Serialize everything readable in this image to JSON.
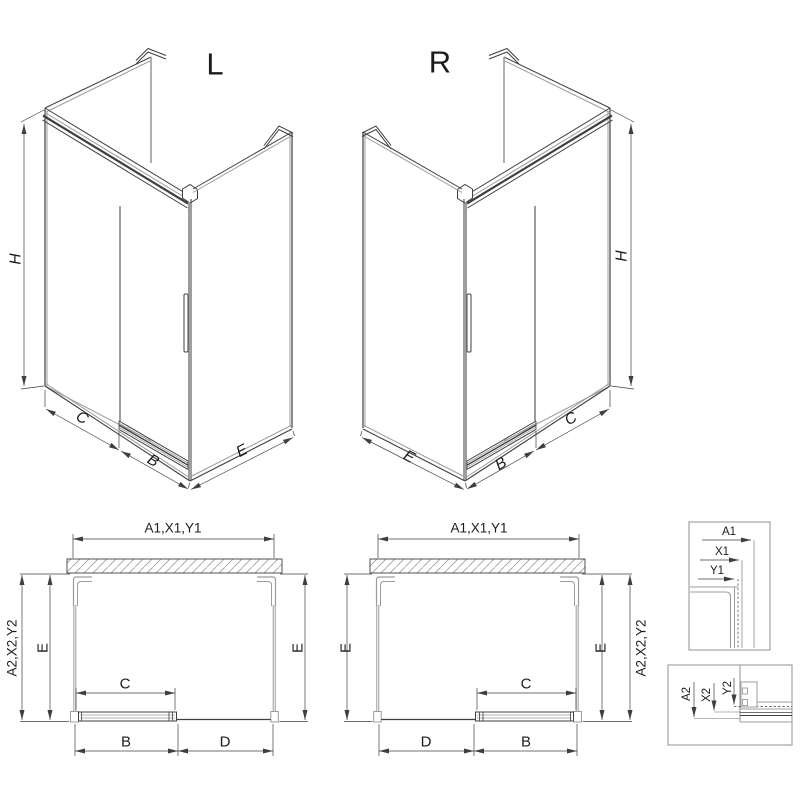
{
  "drawing_title": "shower-enclosure-technical-drawing",
  "colors": {
    "line_dark": "#3f3f41",
    "line_light": "#9c9ca0",
    "text": "#1c1c1c",
    "background": "#ffffff",
    "handle_fill": "#d9d9db"
  },
  "iso_left": {
    "label": "L",
    "dim_h": "H",
    "dim_c": "C",
    "dim_b": "B",
    "dim_e": "E"
  },
  "iso_right": {
    "label": "R",
    "dim_h": "H",
    "dim_c": "C",
    "dim_b": "B",
    "dim_e": "E"
  },
  "plan_left": {
    "dim_top": "A1,X1,Y1",
    "dim_side": "A2,X2,Y2",
    "dim_depth_left": "E",
    "dim_depth_right": "E",
    "dim_door": "C",
    "dim_bottom_left": "B",
    "dim_bottom_right": "D"
  },
  "plan_right": {
    "dim_top": "A1,X1,Y1",
    "dim_side": "A2,X2,Y2",
    "dim_depth_left": "E",
    "dim_depth_right": "E",
    "dim_door": "C",
    "dim_bottom_left": "D",
    "dim_bottom_right": "B"
  },
  "detail_top": {
    "dim_a1": "A1",
    "dim_x1": "X1",
    "dim_y1": "Y1"
  },
  "detail_bottom": {
    "dim_a2": "A2",
    "dim_x2": "X2",
    "dim_y2": "Y2"
  }
}
